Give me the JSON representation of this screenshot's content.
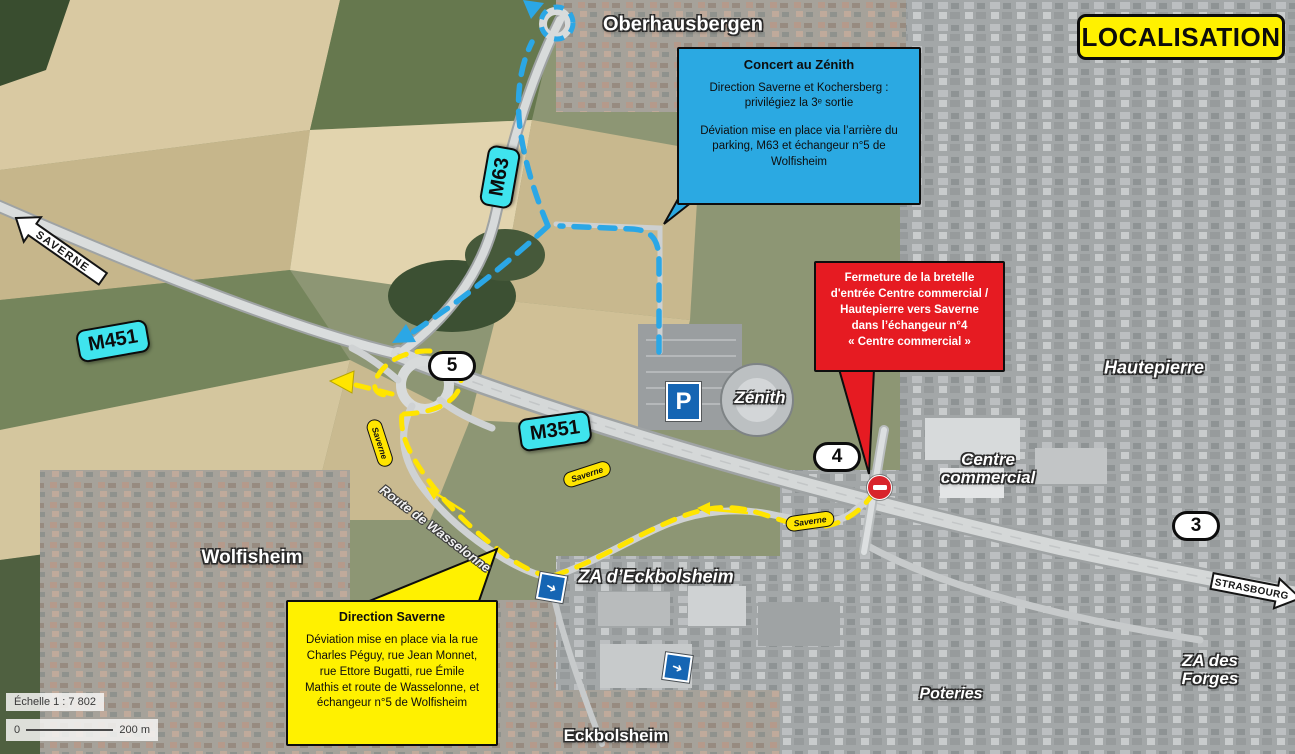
{
  "header": {
    "title": "LOCALISATION"
  },
  "scalebar": {
    "label": "Échelle 1 : 7 802",
    "zero": "0",
    "distance": "200 m"
  },
  "callouts": {
    "concert": {
      "title": "Concert au Zénith",
      "para1": "Direction Saverne et Kochersberg :\nprivilégiez la 3ᵉ sortie",
      "para2": "Déviation mise en place via l’arrière du\nparking, M63 et échangeur n°5 de\nWolfisheim"
    },
    "fermeture": {
      "text": "Fermeture de la bretelle\nd'entrée Centre commercial /\nHautepierre vers Saverne\ndans l’échangeur n°4\n« Centre commercial »"
    },
    "deviation": {
      "title": "Direction Saverne",
      "body": "Déviation mise en place via la rue\nCharles Péguy, rue Jean Monnet,\nrue Ettore Bugatti, rue Émile\nMathis et route de Wasselonne, et\néchangeur n°5 de Wolfisheim"
    }
  },
  "roads": {
    "m451": "M451",
    "m63": "M63",
    "m351": "M351"
  },
  "interchanges": {
    "n5": "5",
    "n4": "4",
    "n3": "3"
  },
  "signs": {
    "saverne": "SAVERNE",
    "strasbourg": "STRASBOURG"
  },
  "route_tags": {
    "t1": "Saverne",
    "t2": "Saverne",
    "t3": "Saverne"
  },
  "places": {
    "oberhausbergen": "Oberhausbergen",
    "hautepierre": "Hautepierre",
    "zenith": "Zénith",
    "centre_commercial": "Centre\ncommercial",
    "wolfisheim": "Wolfisheim",
    "za_eckbolsheim": "ZA d’Eckbolsheim",
    "za_des_forges": "ZA des Forges",
    "poteries": "Poteries",
    "eckbolsheim": "Eckbolsheim",
    "route_wasselonne": "Route de Wasselonne"
  },
  "icons": {
    "parking_label": "P",
    "mandatory_arrow": "➜"
  },
  "colors": {
    "callout_blue": "#2BA9E2",
    "callout_red": "#E61B22",
    "annotation_yellow": "#FFF100",
    "road_badge_cyan": "#3FE4EE",
    "route_yellow": "#FFE500",
    "route_blue": "#2BA7E6"
  }
}
